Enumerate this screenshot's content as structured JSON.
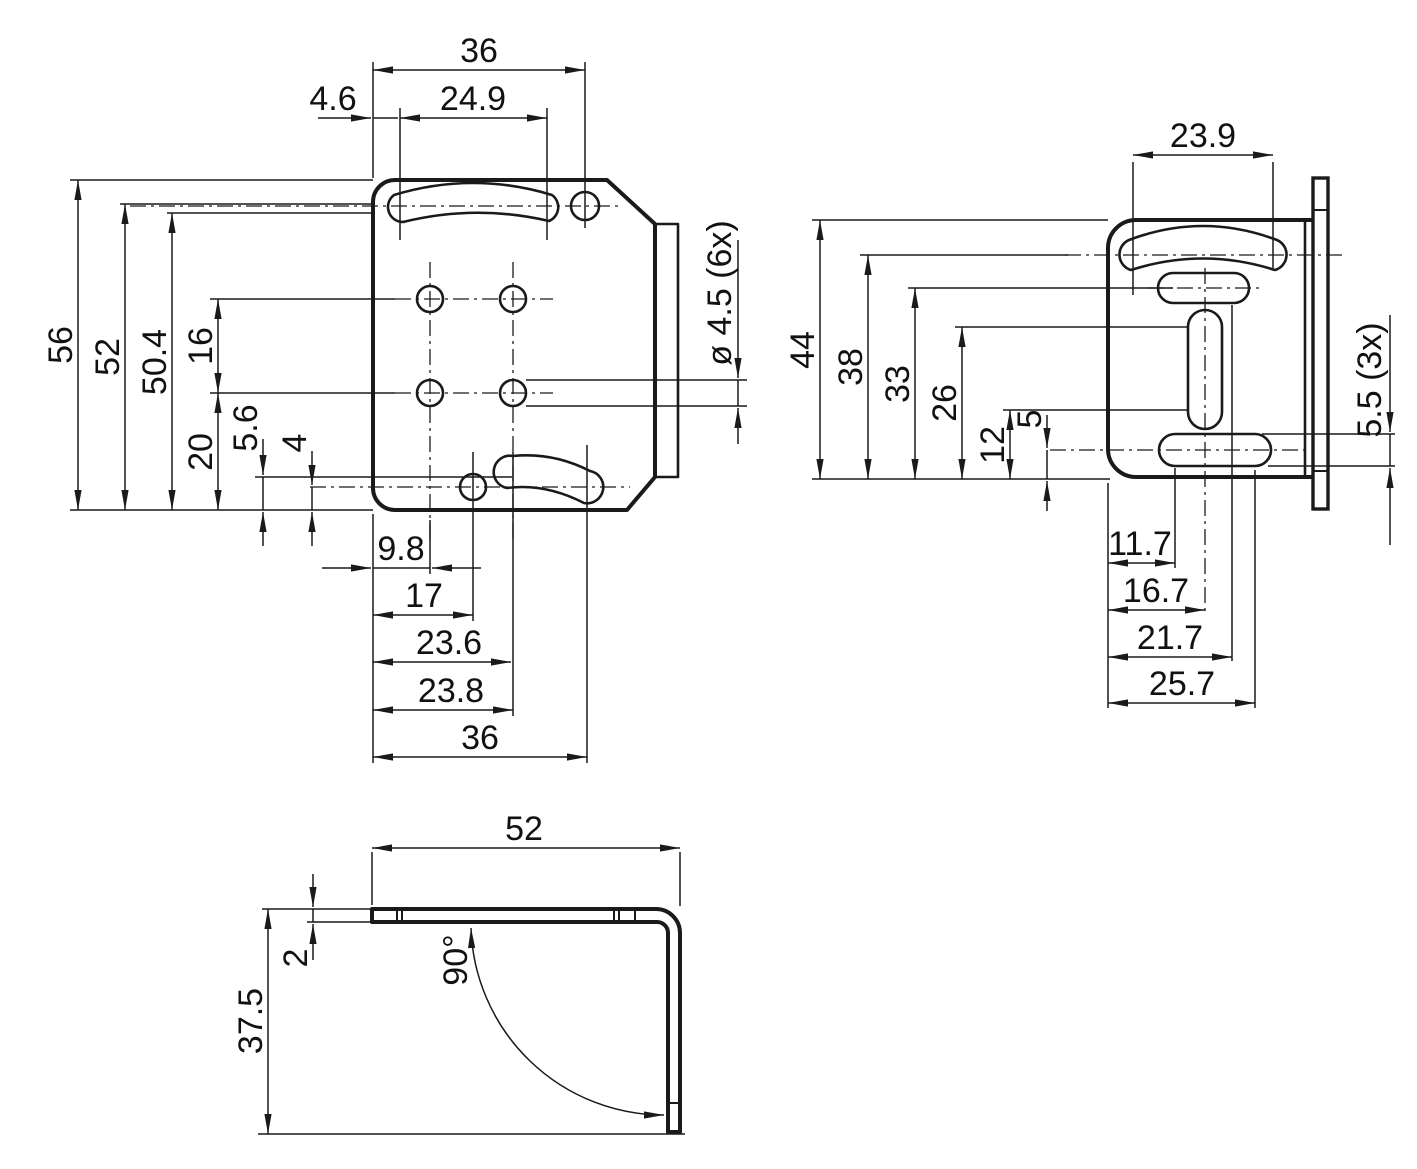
{
  "front_view": {
    "top_width": "36",
    "top_offset": "4.6",
    "top_slot_span": "24.9",
    "height_total": "56",
    "height_slot": "52",
    "height_slot_edge": "50.4",
    "hole_row_spacing": "16",
    "hole_row_to_bottom": "20",
    "bottom_slot_edge": "5.6",
    "bottom_slot_center": "4",
    "bottom_left_hole": "9.8",
    "bottom_pivot": "17",
    "bottom_right_hole": "23.6",
    "bottom_slot_left": "23.8",
    "bottom_width": "36",
    "hole_note": "ø 4.5 (6x)"
  },
  "side_view": {
    "top_slot_span": "23.9",
    "height_total": "44",
    "height_top_slot": "38",
    "height_pill_slot": "33",
    "height_vslot_top": "26",
    "height_vslot_bottom": "12",
    "height_bottom_slot": "5",
    "bottom_slot_left": "11.7",
    "bottom_vslot": "16.7",
    "bottom_pill_right": "21.7",
    "bottom_slot_right": "25.7",
    "slot_note": "5.5 (3x)"
  },
  "profile_view": {
    "width": "52",
    "thickness": "2",
    "height": "37.5",
    "bend_angle": "90°"
  },
  "colors": {
    "line": "#1a1a1a",
    "background": "#ffffff"
  }
}
